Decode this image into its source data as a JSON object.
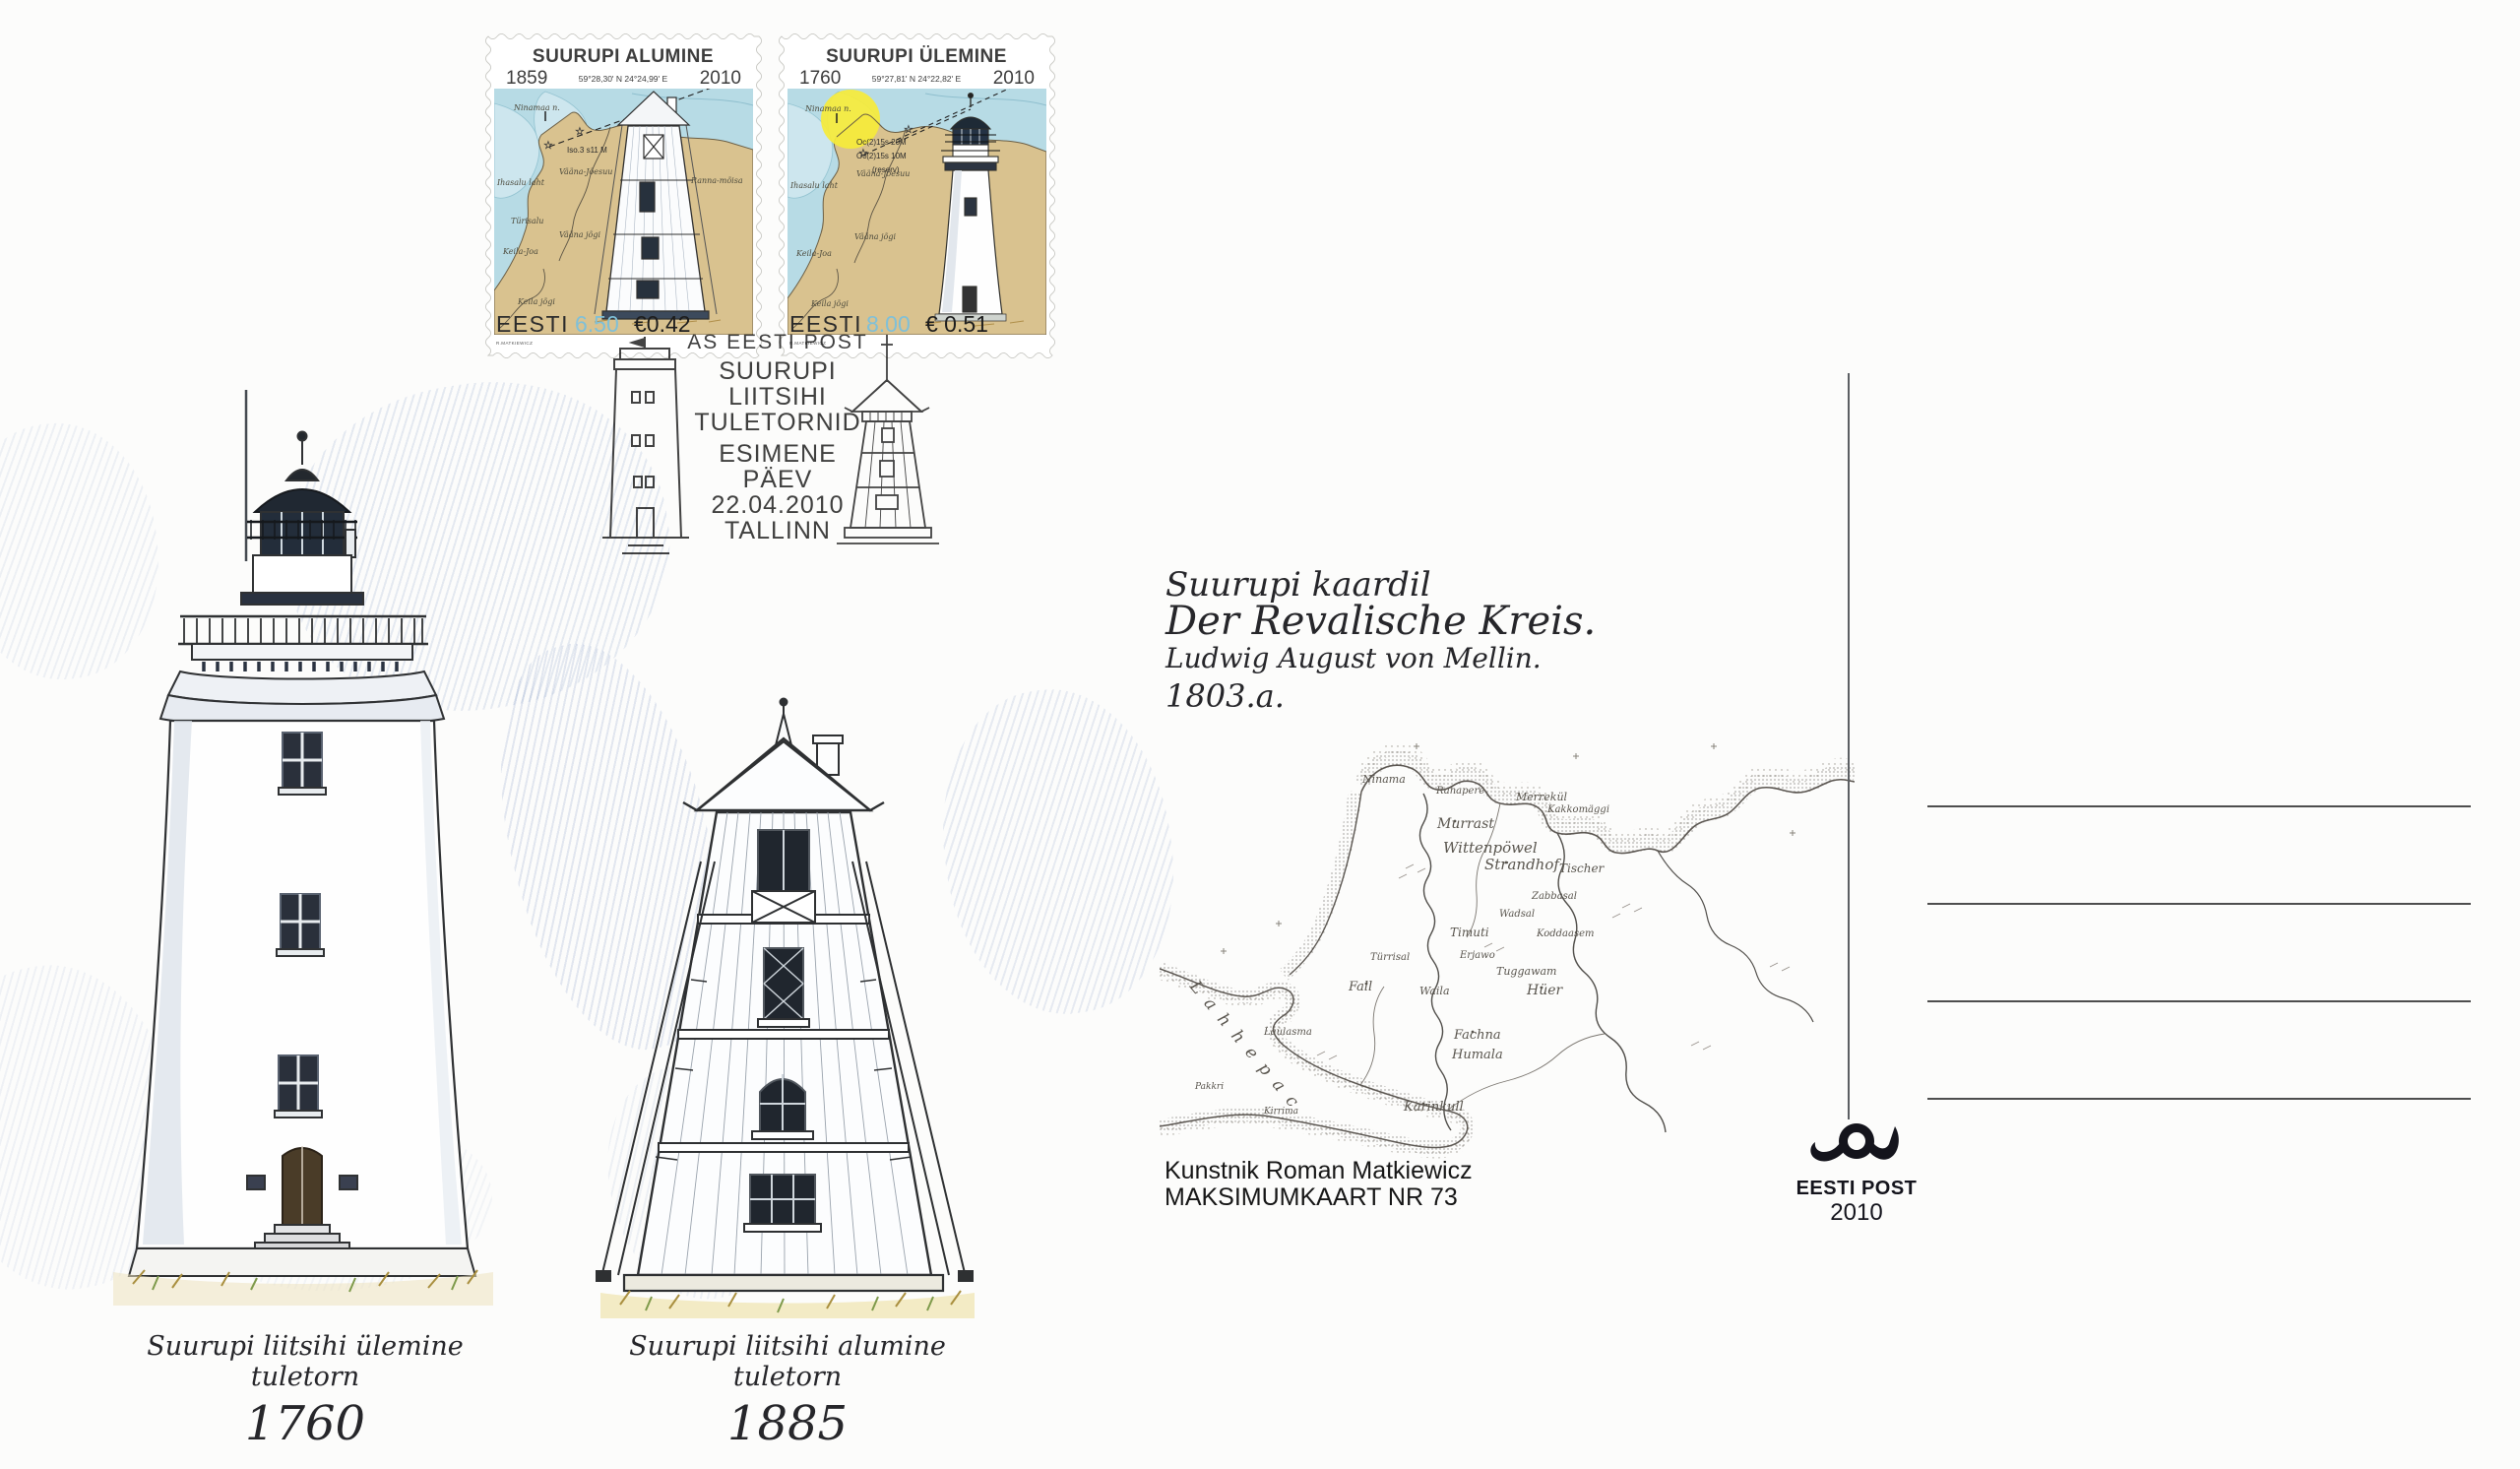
{
  "colors": {
    "stamp_land": "#d9c28f",
    "stamp_water": "#b7dbe5",
    "stamp_value_blue": "#7fc0d8",
    "yellow_sector": "#f6ec3a",
    "cancel_ink": "#2e2e2e",
    "pencil_cloud_blue": "#6884ba"
  },
  "stamps": [
    {
      "title": "SUURUPI ALUMINE",
      "year_built": "1859",
      "coordinates": "59°28,30' N   24°24,99' E",
      "year_issued": "2010",
      "light_characteristic": "Iso.3 s11 M",
      "labels": {
        "cape": "Ninamaa n.",
        "bay": "Ihasalu laht",
        "rivermouth": "Vääna-Jõesuu",
        "estate": "Ranna-mõisa",
        "village": "Türisalu",
        "river1": "Vääna jõgi",
        "place": "Keila-Joa",
        "river2": "Keila jõgi"
      },
      "country": "EESTI",
      "value_kroons": "6.50",
      "value_euros": "€0.42",
      "engraver": "R.MATKIEWICZ"
    },
    {
      "title": "SUURUPI ÜLEMINE",
      "year_built": "1760",
      "coordinates": "59°27,81' N   24°22,82' E",
      "year_issued": "2010",
      "light_characteristic1": "Oc(2)15s 20M",
      "light_characteristic2": "Oc(2)15s 10M",
      "light_characteristic3": "(reserv)",
      "labels": {
        "cape": "Ninamaa n.",
        "bay": "Ihasalu laht",
        "rivermouth": "Vääna-Jõesuu",
        "river1": "Vääna jõgi",
        "place": "Keila-Joa",
        "river2": "Keila jõgi"
      },
      "country": "EESTI",
      "value_kroons": "8.00",
      "value_euros": "€ 0.51",
      "engraver": "R.MATKIEWICZ"
    }
  ],
  "postmark": {
    "issuer": "AS EESTI POST",
    "title_line1": "SUURUPI",
    "title_line2": "LIITSIHI",
    "title_line3": "TULETORNID",
    "event_line1": "ESIMENE",
    "event_line2": "PÄEV",
    "date": "22.04.2010",
    "place": "TALLINN"
  },
  "drawings": {
    "caption_left_line": "Suurupi liitsihi ülemine tuletorn",
    "caption_left_year": "1760",
    "caption_right_line": "Suurupi liitsihi alumine tuletorn",
    "caption_right_year": "1885"
  },
  "map_note": {
    "line1": "Suurupi kaardil",
    "line2": "Der Revalische Kreis.",
    "line3": "Ludwig August von Mellin.",
    "line4": "1803.a."
  },
  "old_map": {
    "sea_name": "Lahhepac",
    "labels": [
      "Ninama",
      "Ranapere",
      "Merrekül",
      "Kakkomäggi",
      "Murrast",
      "Wittenpöwel",
      "Strandhof",
      "Tischer",
      "Zabbasal",
      "Wadsal",
      "Koddaasem",
      "Timuti",
      "Erjawo",
      "Türrisal",
      "Tuggawam",
      "Hüer",
      "Fall",
      "Waila",
      "Fachna",
      "Humala",
      "Laulasma",
      "Karinkull",
      "Kirrima",
      "Pakkri"
    ]
  },
  "credits": {
    "artist": "Kunstnik Roman Matkiewicz",
    "series": "MAKSIMUMKAART NR 73"
  },
  "publisher": {
    "name": "EESTI POST",
    "year": "2010"
  }
}
